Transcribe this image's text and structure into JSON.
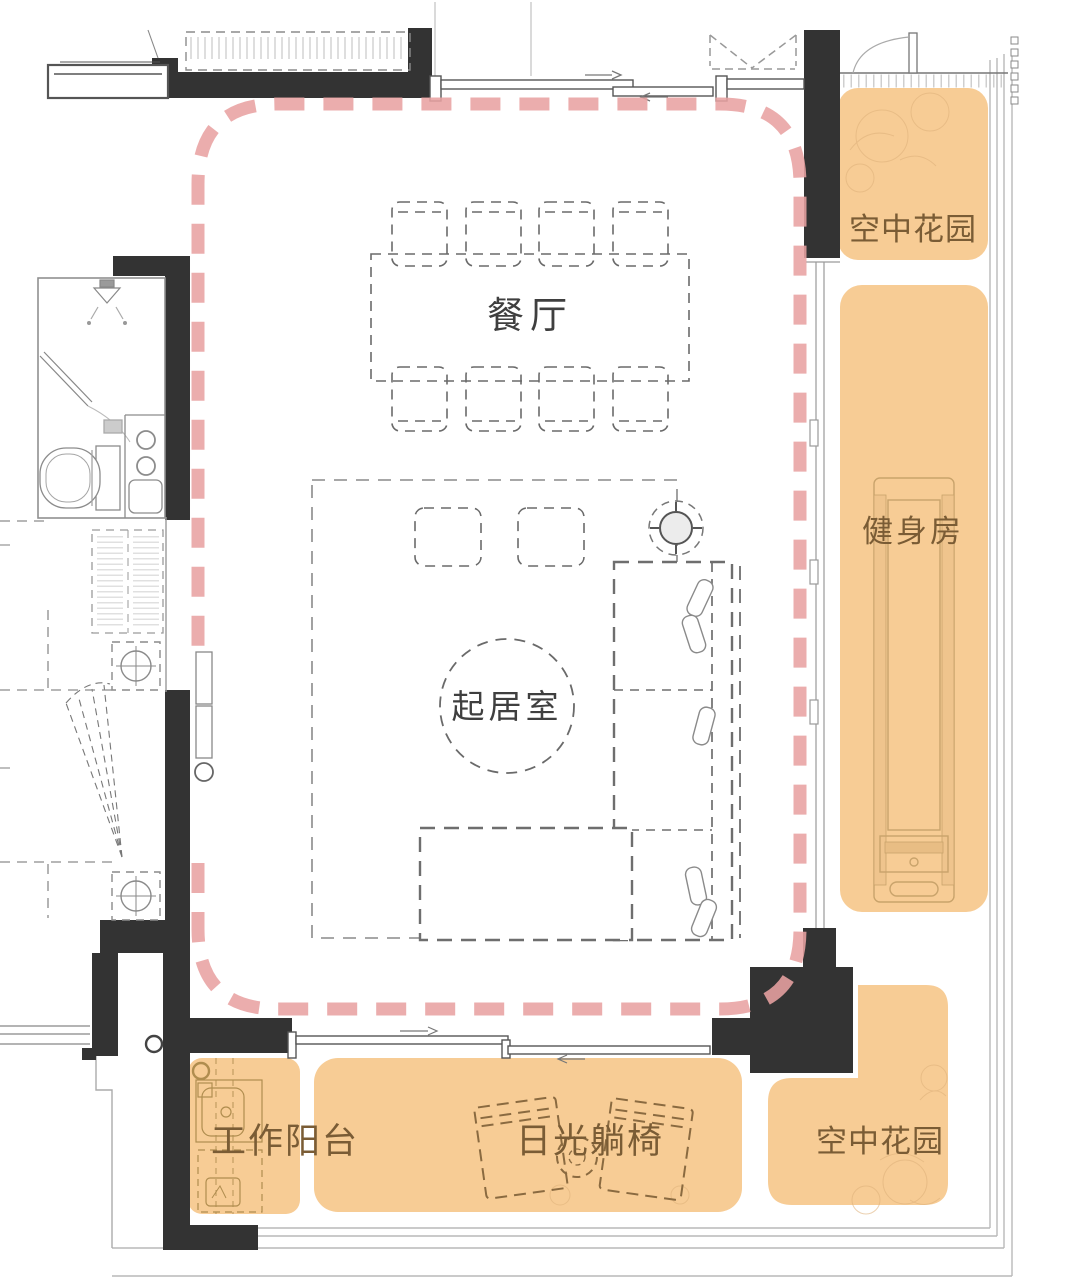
{
  "rooms": {
    "dining": {
      "label": "餐厅"
    },
    "living": {
      "label": "起居室"
    },
    "sky_garden_top": {
      "label": "空中花园"
    },
    "gym": {
      "label": "健身房"
    },
    "sky_garden_bottom": {
      "label": "空中花园"
    },
    "work_balcony": {
      "label": "工作阳台"
    },
    "sun_lounger": {
      "label": "日光躺椅"
    }
  },
  "colors": {
    "highlight_outline": "#E8A2A2",
    "amenity_fill": "#F7CC95",
    "amenity_label": "#7A5C35",
    "room_label": "#3F3F3F",
    "wall": "#333333",
    "fixture_line": "#C9A36B"
  }
}
